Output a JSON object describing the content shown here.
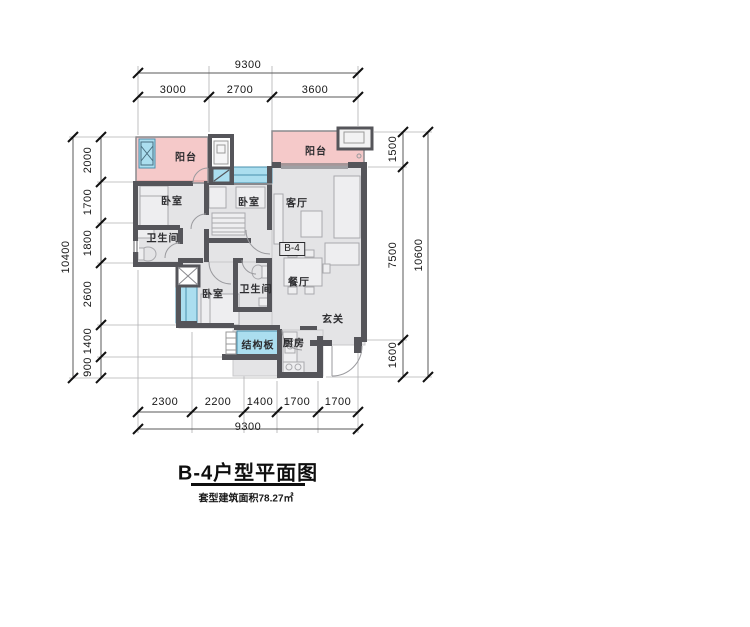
{
  "title_block": {
    "title": "B-4户型平面图",
    "subtitle": "套型建筑面积78.27㎡"
  },
  "plan": {
    "unit_label": "B-4",
    "rooms": {
      "balcony_left": "阳台",
      "balcony_right": "阳台",
      "bedroom_left": "卧室",
      "bedroom_middle": "卧室",
      "bedroom_bottom": "卧室",
      "bathroom_left": "卫生间",
      "bathroom_middle": "卫生间",
      "living_room": "客厅",
      "dining_room": "餐厅",
      "entry": "玄关",
      "kitchen": "厨房",
      "structural_slab": "结构板"
    }
  },
  "dims": {
    "top_total": "9300",
    "top_segments": [
      "3000",
      "2700",
      "3600"
    ],
    "bottom_segments": [
      "2300",
      "2200",
      "1400",
      "1700",
      "1700"
    ],
    "bottom_total": "9300",
    "left_total": "10400",
    "left_segments": [
      "2000",
      "1700",
      "1800",
      "2600",
      "1400",
      "900"
    ],
    "right_segments": [
      "1500",
      "7500",
      "1600"
    ],
    "right_total": "10600"
  },
  "colors": {
    "wall": "#55555a",
    "floor": "#e4e4e6",
    "balcony": "#f5c9c9",
    "window": "#abdeef"
  }
}
